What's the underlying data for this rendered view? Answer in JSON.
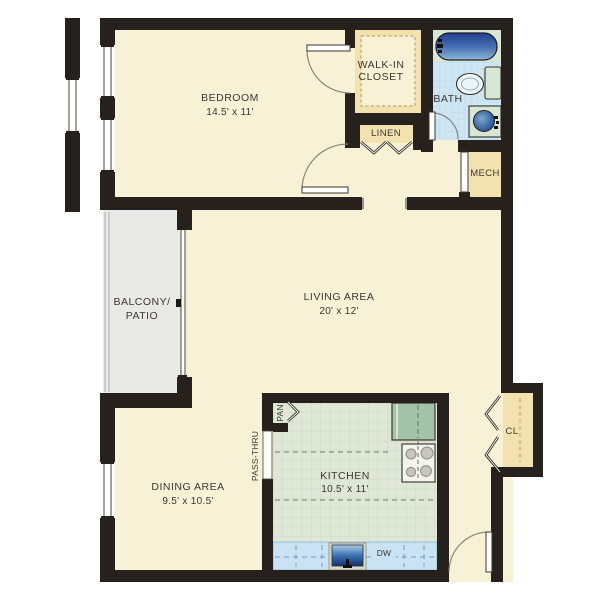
{
  "rooms": {
    "bedroom": {
      "name": "BEDROOM",
      "dims": "14.5' x 11'"
    },
    "walk_in_closet": {
      "line1": "WALK-IN",
      "line2": "CLOSET"
    },
    "bath": {
      "name": "BATH"
    },
    "linen": {
      "name": "LINEN"
    },
    "mech": {
      "name": "MECH"
    },
    "balcony": {
      "line1": "BALCONY/",
      "line2": "PATIO"
    },
    "living": {
      "name": "LIVING AREA",
      "dims": "20' x 12'"
    },
    "dining": {
      "name": "DINING AREA",
      "dims": "9.5' x 10.5'"
    },
    "kitchen": {
      "name": "KITCHEN",
      "dims": "10.5' x 11'"
    },
    "entry_closet": {
      "name": "CL"
    },
    "pantry": {
      "name": "PAN"
    },
    "pass_thru": {
      "name": "PASS-THRU"
    },
    "dishwasher": {
      "name": "DW"
    }
  },
  "colors": {
    "wall": "#26211c",
    "floor_cream": "#f7f2d5",
    "closet_tan": "#f2e2b0",
    "balcony_gray": "#e9e9e7",
    "kitchen_floor": "#dfe7d7",
    "kitchen_grid": "#cbd8c5",
    "bath_floor": "#cfe6f3",
    "bath_grid": "#b9d7e9",
    "counter_blue": "#cae3f4",
    "counter_dash": "#6f9cbe",
    "fixture_green": "#d8e7d3",
    "appliance_green": "#a3c4a8",
    "tub_blue_dark": "#24418f",
    "tub_blue_light": "#8fb6d9",
    "sink_navy": "#16306e",
    "door_swing": "#8a857c",
    "window_line": "#4a453f",
    "label_text": "#3b3733"
  }
}
